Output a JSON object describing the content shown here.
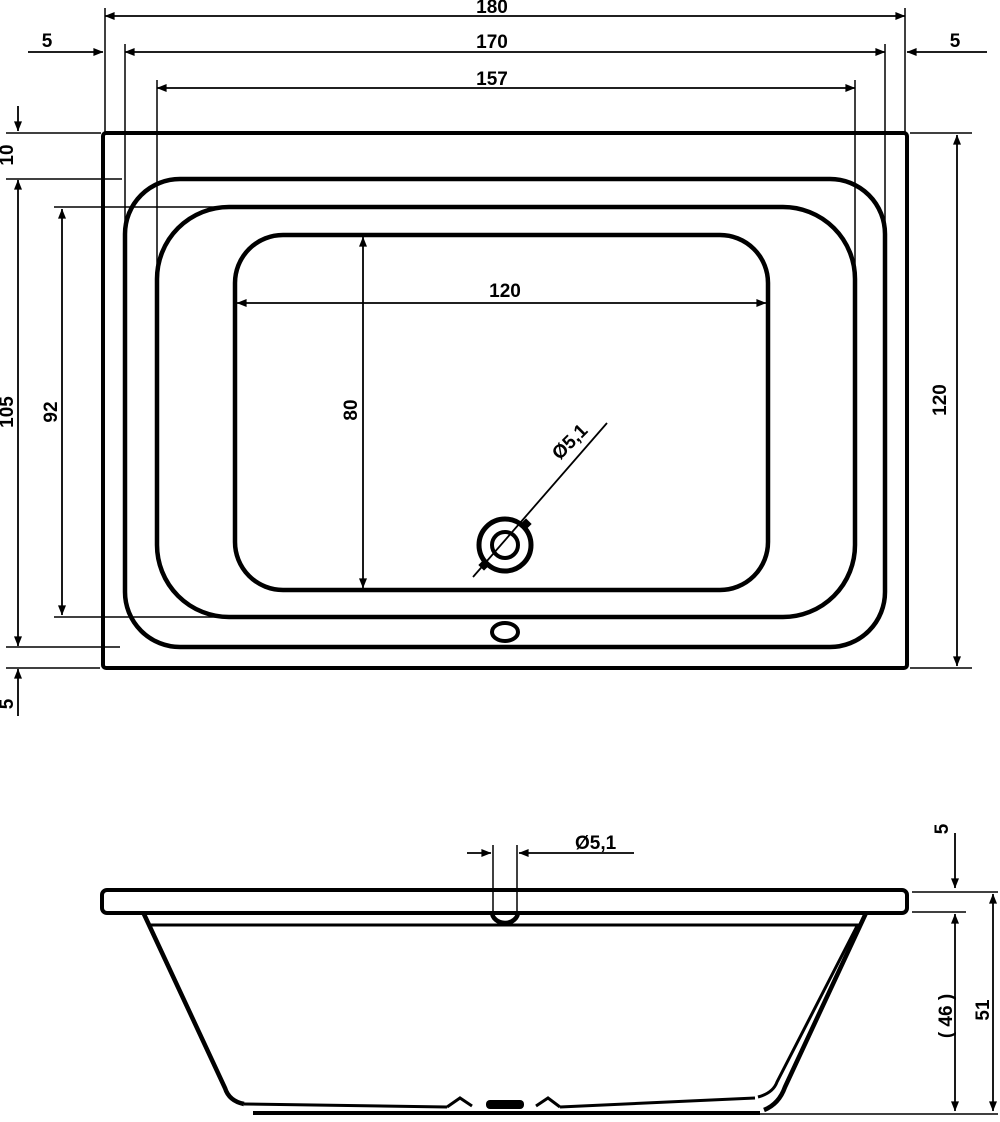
{
  "drawing": {
    "title": "bathtub-technical-drawing",
    "units": "cm",
    "line_color": "#000000",
    "background": "#ffffff",
    "top_view": {
      "overall_width": "180",
      "rim_inner_width": "170",
      "basin_top_width": "157",
      "side_gap_left": "5",
      "side_gap_right": "5",
      "top_gap": "10",
      "rim_inner_height": "105",
      "basin_top_height": "92",
      "bottom_gap": "5",
      "overall_height": "120",
      "floor_width": "120",
      "floor_height": "80",
      "drain_diameter": "Ø5,1"
    },
    "side_view": {
      "drain_diameter": "Ø5,1",
      "rim_thickness": "5",
      "body_height": "( 46 )",
      "total_height": "51"
    }
  }
}
